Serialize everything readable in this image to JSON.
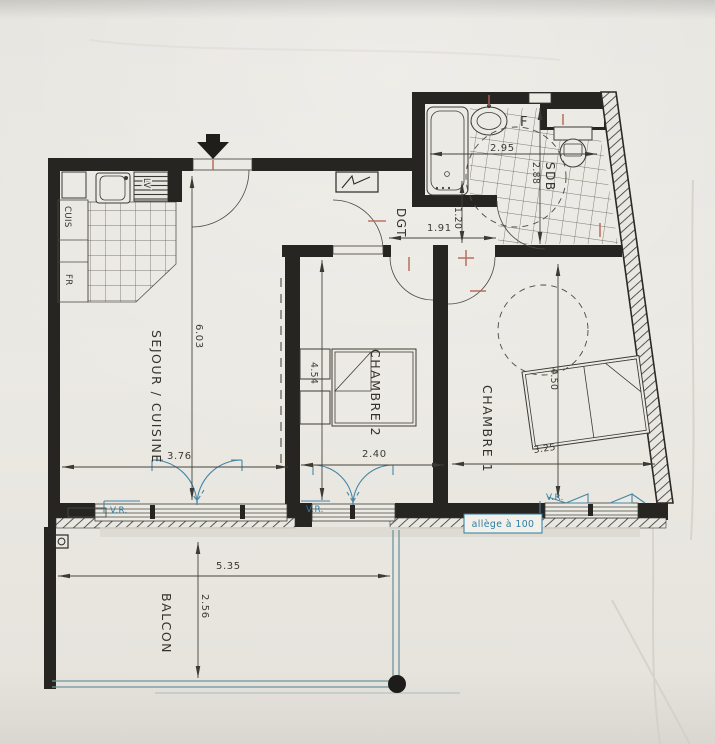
{
  "photo": {
    "paper_color": "#ebe9e3"
  },
  "plan": {
    "rooms": {
      "sejour_cuisine": "SEJOUR / CUISINE",
      "chambre2": "CHAMBRE 2",
      "chambre1": "CHAMBRE 1",
      "dgt": "DGT",
      "sdb": "SDB",
      "balcon": "BALCON"
    },
    "equipment": {
      "cuisiniere": "CUIS",
      "frigo": "FR",
      "lave_vaisselle": "LV",
      "fenetre": "F"
    },
    "dimensions": {
      "sejour_length": "6.03",
      "sejour_width": "3.76",
      "chambre2_width": "2.40",
      "chambre2_length": "4.54",
      "chambre1_width": "3.25",
      "chambre1_length": "4.50",
      "dgt_width": "1.91",
      "dgt_depth": "1.20",
      "sdb_width": "2.95",
      "sdb_length": "2.88",
      "balcon_width": "5.35",
      "balcon_depth": "2.56"
    },
    "annotations": {
      "vr_sejour": "V.R.",
      "vr_chambre2": "V.R.",
      "vr_chambre1": "V.R.",
      "allege": "allège à 100"
    },
    "colors": {
      "wall": "#262522",
      "ink": "#3a3935",
      "blue": "#2f7da2",
      "red": "#b4614f"
    }
  }
}
